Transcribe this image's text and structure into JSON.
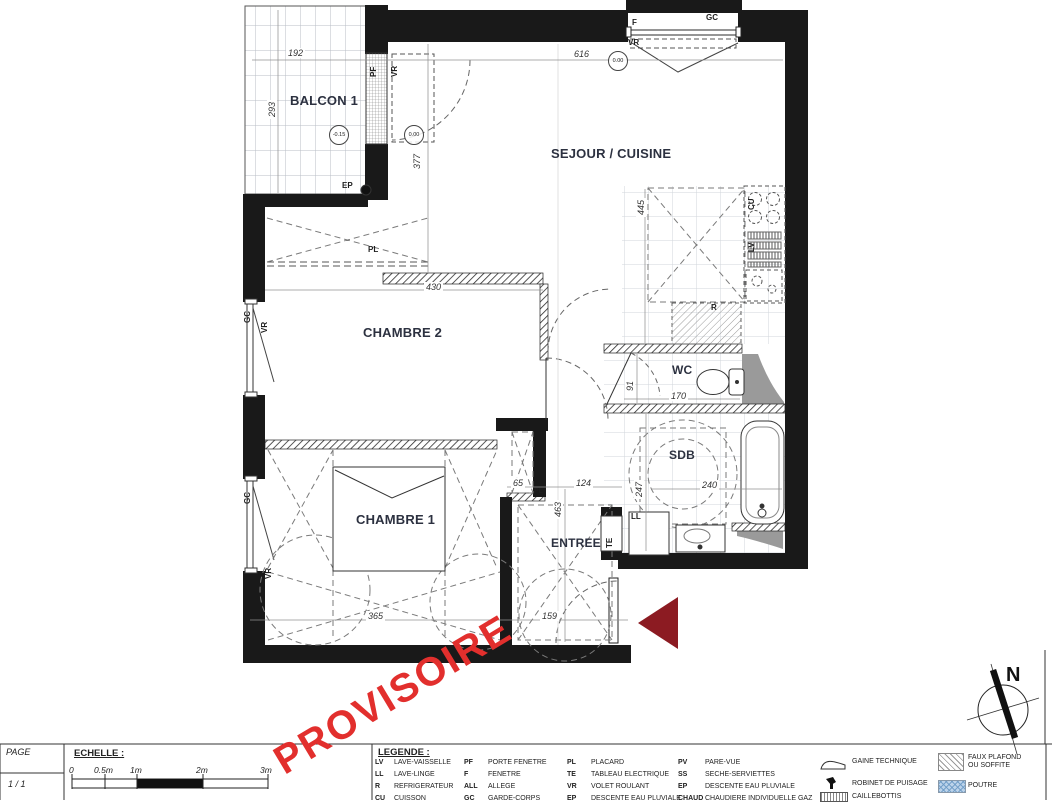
{
  "watermark": "PROVISOIRE",
  "compass_n": "N",
  "colors": {
    "watermark": "#e22f2d",
    "entry_arrow": "#8c1b22",
    "poutre_fill": "#bcd3ea"
  },
  "plan": {
    "rooms": {
      "balcon": "BALCON 1",
      "sejour": "SEJOUR / CUISINE",
      "chambre2": "CHAMBRE 2",
      "chambre1": "CHAMBRE 1",
      "wc": "WC",
      "sdb": "SDB",
      "entree": "ENTREE"
    },
    "levels": {
      "balcon": "-0.15",
      "sejour_door": "0.00",
      "sejour_top": "0.00"
    },
    "dims": {
      "d192": "192",
      "d293": "293",
      "d616": "616",
      "d377": "377",
      "d445": "445",
      "d430": "430",
      "d91": "91",
      "d170": "170",
      "d247": "247",
      "d240": "240",
      "d65": "65",
      "d124": "124",
      "d463": "463",
      "d365": "365",
      "d159": "159"
    },
    "tags": {
      "pf": "PF",
      "vr": "VR",
      "f": "F",
      "gc": "GC",
      "ep": "EP",
      "pl": "PL",
      "te": "TE",
      "ll": "LL",
      "r": "R",
      "cu": "CU",
      "lv": "LV"
    }
  },
  "title_block": {
    "page": {
      "label": "PAGE",
      "value": "1 / 1"
    },
    "scale": {
      "label": "ECHELLE :",
      "ticks": [
        "0",
        "0.5m",
        "1m",
        "2m",
        "3m"
      ]
    },
    "legend": {
      "title": "LEGENDE :",
      "abbrev": [
        {
          "abbr": "LV",
          "label": "LAVE-VAISSELLE"
        },
        {
          "abbr": "LL",
          "label": "LAVE-LINGE"
        },
        {
          "abbr": "R",
          "label": "REFRIGERATEUR"
        },
        {
          "abbr": "CU",
          "label": "CUISSON"
        },
        {
          "abbr": "PF",
          "label": "PORTE FENETRE"
        },
        {
          "abbr": "F",
          "label": "FENETRE"
        },
        {
          "abbr": "ALL",
          "label": "ALLEGE"
        },
        {
          "abbr": "GC",
          "label": "GARDE-CORPS"
        },
        {
          "abbr": "PL",
          "label": "PLACARD"
        },
        {
          "abbr": "TE",
          "label": "TABLEAU ELECTRIQUE"
        },
        {
          "abbr": "VR",
          "label": "VOLET ROULANT"
        },
        {
          "abbr": "EP",
          "label": "DESCENTE EAU PLUVIALE"
        },
        {
          "abbr": "PV",
          "label": "PARE-VUE"
        },
        {
          "abbr": "SS",
          "label": "SECHE-SERVIETTES"
        },
        {
          "abbr": "EP",
          "label": "DESCENTE EAU PLUVIALE"
        },
        {
          "abbr": "CHAUD",
          "label": "CHAUDIERE INDIVIDUELLE GAZ"
        }
      ],
      "symbols": [
        {
          "label": "GAINE TECHNIQUE"
        },
        {
          "label": "ROBINET DE PUISAGE"
        },
        {
          "label": "CAILLEBOTTIS"
        },
        {
          "label": "FAUX PLAFOND OU SOFFITE"
        },
        {
          "label": "POUTRE"
        }
      ]
    }
  }
}
